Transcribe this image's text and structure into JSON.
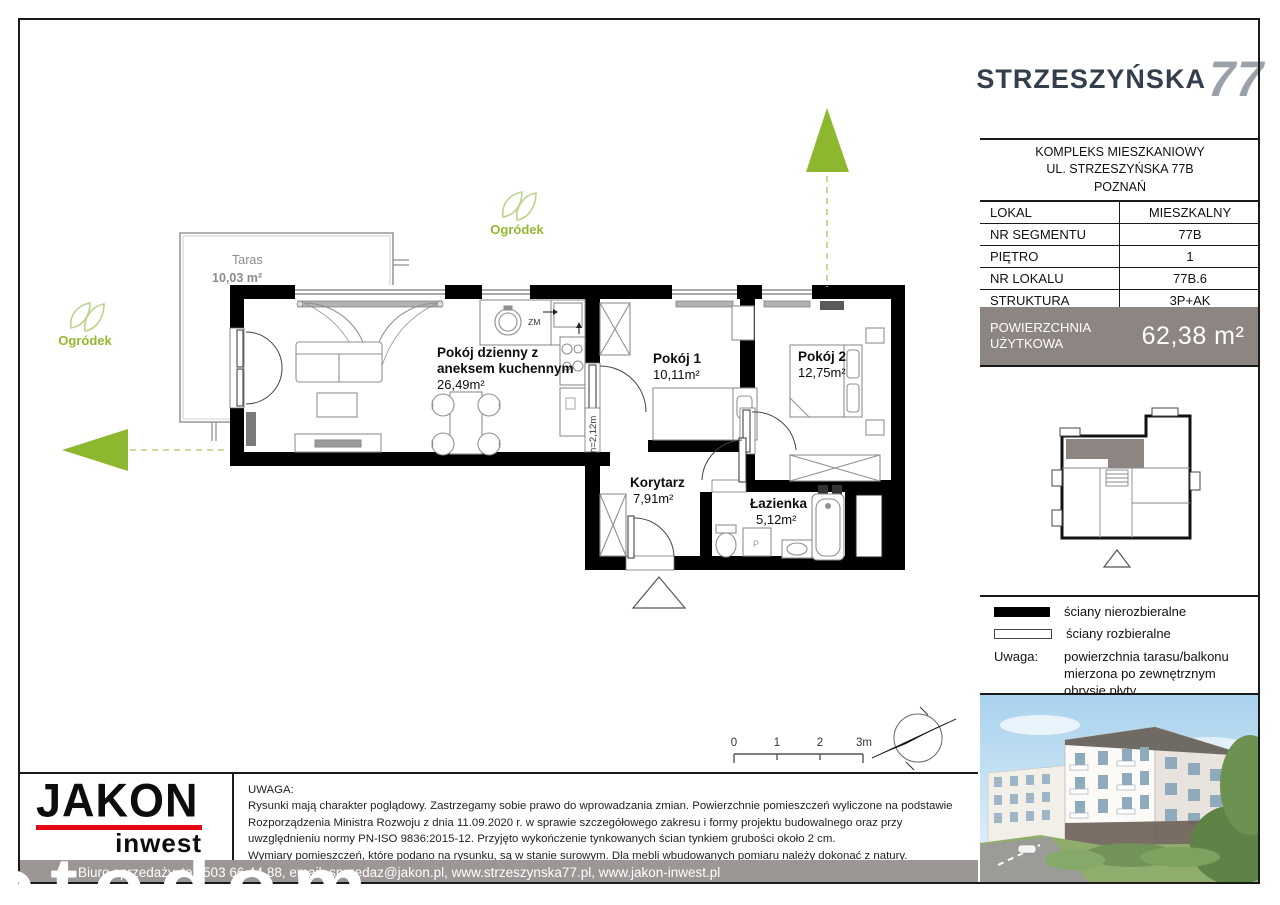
{
  "title_block": {
    "logo_text": "STRZESZYŃSKA",
    "logo_number": "77",
    "address_lines": [
      "KOMPLEKS MIESZKANIOWY",
      "UL. STRZESZYŃSKA 77B",
      "POZNAŃ"
    ],
    "table": [
      {
        "label": "LOKAL",
        "value": "MIESZKALNY"
      },
      {
        "label": "NR SEGMENTU",
        "value": "77B"
      },
      {
        "label": "PIĘTRO",
        "value": "1"
      },
      {
        "label": "NR LOKALU",
        "value": "77B.6"
      },
      {
        "label": "STRUKTURA",
        "value": "3P+AK"
      }
    ],
    "area_label": "POWIERZCHNIA UŻYTKOWA",
    "area_value": "62,38 m²"
  },
  "legend": {
    "items": [
      {
        "swatch": "filled",
        "label": "ściany nierozbieralne"
      },
      {
        "swatch": "outline",
        "label": "ściany rozbieralne"
      }
    ],
    "note_label": "Uwaga:",
    "note_text": "powierzchnia tarasu/balkonu mierzona po zewnętrznym obrysie płyty"
  },
  "plan": {
    "rooms": [
      {
        "name_lines": [
          "Pokój dzienny z",
          "aneksem kuchennym"
        ],
        "area": "26,49m²"
      },
      {
        "name": "Pokój 1",
        "area": "10,11m²"
      },
      {
        "name": "Pokój 2",
        "area": "12,75m²"
      },
      {
        "name": "Korytarz",
        "area": "7,91m²"
      },
      {
        "name": "Łazienka",
        "area": "5,12m²"
      }
    ],
    "terrace": {
      "name": "Taras",
      "area": "10,03 m²"
    },
    "garden_label": "Ogródek",
    "annotations": {
      "height_note": "h=2,12m",
      "dishwasher": "ZM",
      "washer": "P"
    },
    "scale_ticks": [
      "0",
      "1",
      "2",
      "3m"
    ]
  },
  "footer": {
    "brand_name": "JAKON",
    "brand_sub": "inwest",
    "disclaimer_title": "UWAGA:",
    "disclaimer_lines": [
      "Rysunki mają charakter poglądowy. Zastrzegamy sobie prawo do wprowadzania zmian. Powierzchnie pomieszczeń wyliczone na podstawie",
      "Rozporządzenia Ministra Rozwoju z dnia 11.09.2020 r. w sprawie szczegółowego zakresu i formy projektu budowalnego oraz przy",
      "uwzględnieniu normy PN-ISO 9836:2015-12. Przyjęto wykończenie tynkowanych ścian tynkiem grubości około 2 cm.",
      "Wymiary pomieszczeń, które podano na rysunku, są w stanie surowym. Dla mebli wbudowanych pomiaru należy dokonać z natury."
    ],
    "contact_bar": "Biuro sprzedaży, tel. 503 66 44 88, email: sprzedaz@jakon.pl, www.strzeszynska77.pl, www.jakon-inwest.pl"
  },
  "watermark": "otodom",
  "colors": {
    "accent_green": "#8cb72f",
    "navy": "#343f4e",
    "gray_box": "#8d8581",
    "brand_red": "#e30613"
  }
}
